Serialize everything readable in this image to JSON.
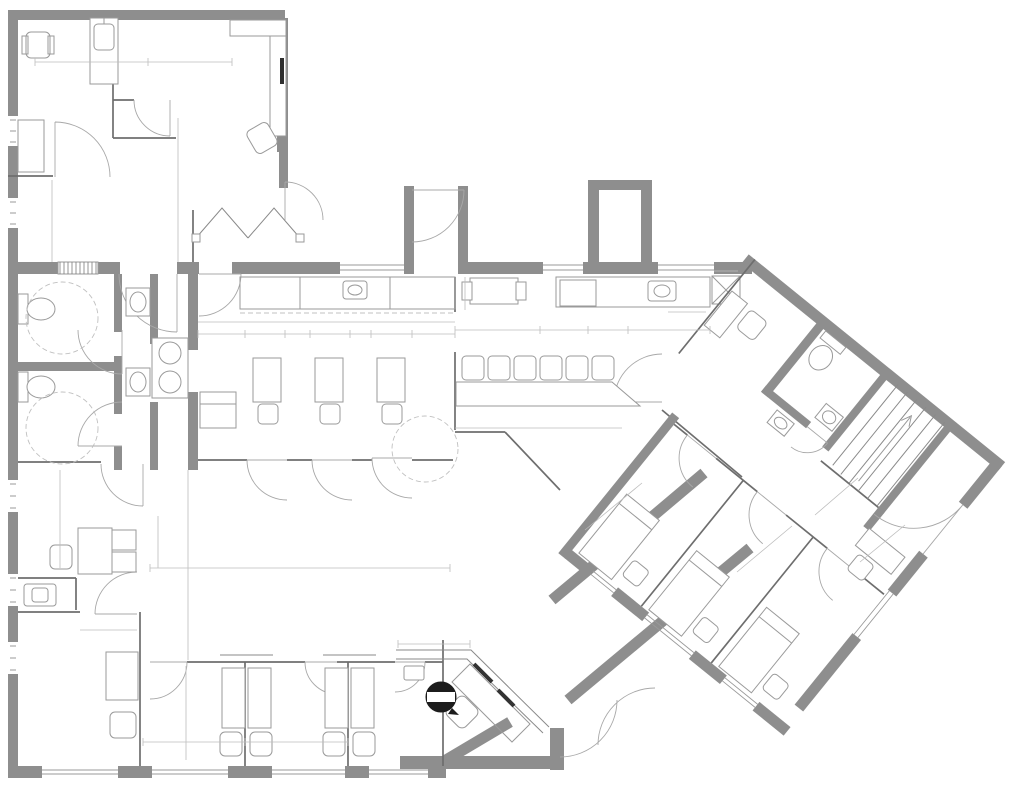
{
  "watermark": {
    "text": "A11598062 © Miami MLS® 2024"
  },
  "section_callout": {
    "label": "A1.09"
  },
  "colors": {
    "wall_gray": "#8e8e8e",
    "partition_line": "#6e6e6e",
    "dimension_text": "#5f5f5f",
    "watermark_gray": "#9b9b9b",
    "callout_black": "#2f2f2f",
    "background": "#ffffff"
  },
  "dim_labels": [
    {
      "t": "8'-4\"",
      "x": 97,
      "y": 57
    },
    {
      "t": "5'-7\"",
      "x": 185,
      "y": 57
    },
    {
      "t": "4'-0\"",
      "x": 172,
      "y": 155,
      "r": -90
    },
    {
      "t": "4'-7 1/4\"",
      "x": 172,
      "y": 207,
      "r": -90
    },
    {
      "t": "2'-6\"",
      "x": 172,
      "y": 249,
      "r": -90
    },
    {
      "t": "6'-10\"",
      "x": 46,
      "y": 222,
      "r": -90
    },
    {
      "t": "5'-2\"",
      "x": 148,
      "y": 260
    },
    {
      "t": "MIN. CLR.",
      "x": 148,
      "y": 272,
      "s": 6.5
    },
    {
      "t": "7'-6\"",
      "x": 62,
      "y": 327,
      "r": -72
    },
    {
      "t": "MIN. CLR.",
      "x": 152,
      "y": 414,
      "s": 6.5
    },
    {
      "t": "11'-9 1/4\"",
      "x": 180,
      "y": 388,
      "r": -90
    },
    {
      "t": "4'-7 1/4\"",
      "x": 183,
      "y": 447,
      "r": -90
    },
    {
      "t": "2'-0\"",
      "x": 215,
      "y": 438,
      "r": -65
    },
    {
      "t": "21'-4 1/2\"",
      "x": 313,
      "y": 326
    },
    {
      "t": "4'-9 7/8\"",
      "x": 229,
      "y": 341
    },
    {
      "t": "2'-0\"",
      "x": 266,
      "y": 341
    },
    {
      "t": "3'-0\"",
      "x": 297,
      "y": 341
    },
    {
      "t": "2'-0\"",
      "x": 328,
      "y": 341
    },
    {
      "t": "3'-0\"",
      "x": 358,
      "y": 341
    },
    {
      "t": "2'-0\"",
      "x": 389,
      "y": 341
    },
    {
      "t": "4'-6 3/4\"",
      "x": 428,
      "y": 341
    },
    {
      "t": "3'-0\"",
      "x": 221,
      "y": 369
    },
    {
      "t": "3 X 3",
      "x": 216,
      "y": 389,
      "s": 6.5
    },
    {
      "t": "3'-0\"",
      "x": 247,
      "y": 376,
      "r": -90
    },
    {
      "t": "1'-8\"",
      "x": 249,
      "y": 413,
      "r": -90
    },
    {
      "t": "68\"",
      "x": 232,
      "y": 312,
      "s": 6
    },
    {
      "t": "3'-0\"",
      "x": 460,
      "y": 294,
      "r": -90
    },
    {
      "t": "7'-0\"",
      "x": 496,
      "y": 324
    },
    {
      "t": "CLR.",
      "x": 497,
      "y": 338
    },
    {
      "t": "4'-0\"",
      "x": 564,
      "y": 324
    },
    {
      "t": "3'-1\"",
      "x": 607,
      "y": 324
    },
    {
      "t": "6'-0\"",
      "x": 662,
      "y": 324
    },
    {
      "t": "CLR.",
      "x": 607,
      "y": 338
    },
    {
      "t": "3'-0\"",
      "x": 686,
      "y": 307
    },
    {
      "t": "MIN. CLR.",
      "x": 346,
      "y": 426,
      "s": 6.5
    },
    {
      "t": "4'-0\"",
      "x": 271,
      "y": 443,
      "r": -90
    },
    {
      "t": "CLR.",
      "x": 286,
      "y": 443,
      "r": -90
    },
    {
      "t": "5'-0\"",
      "x": 420,
      "y": 447
    },
    {
      "t": "CLR.",
      "x": 420,
      "y": 461
    },
    {
      "t": "13'-11 1/8\"",
      "x": 538,
      "y": 422
    },
    {
      "t": "11'-5\"",
      "x": 469,
      "y": 468,
      "r": -90
    },
    {
      "t": "5'-2\"",
      "x": 606,
      "y": 505,
      "r": 39
    },
    {
      "t": "MIN. CLR.",
      "x": 597,
      "y": 517,
      "r": 39,
      "s": 6.5
    },
    {
      "t": "5'-2\"",
      "x": 756,
      "y": 545,
      "r": 39
    },
    {
      "t": "MIN. CLR.",
      "x": 766,
      "y": 556,
      "r": 39,
      "s": 6.5
    },
    {
      "t": "7'-6\"",
      "x": 836,
      "y": 484,
      "r": 39
    },
    {
      "t": "4'-4\"",
      "x": 893,
      "y": 530,
      "r": 39
    },
    {
      "t": "MIN. CLR.",
      "x": 884,
      "y": 542,
      "r": 39,
      "s": 6.5
    },
    {
      "t": "9'-1\"",
      "x": 56,
      "y": 522,
      "r": -90
    },
    {
      "t": "4'-0\"",
      "x": 154,
      "y": 543,
      "r": -90
    },
    {
      "t": "15'-6\"",
      "x": 181,
      "y": 580,
      "r": -90
    },
    {
      "t": "26'-0\"",
      "x": 299,
      "y": 564
    },
    {
      "t": "60\"",
      "x": 108,
      "y": 624,
      "s": 6.5
    },
    {
      "t": "MIN. CLR.",
      "x": 108,
      "y": 634,
      "s": 6.5
    },
    {
      "t": "8'-8\"",
      "x": 182,
      "y": 711,
      "r": -90
    },
    {
      "t": "8'-8\"",
      "x": 203,
      "y": 740
    },
    {
      "t": "8'-8\"",
      "x": 302,
      "y": 740
    },
    {
      "t": "4'-0\"",
      "x": 436,
      "y": 638
    },
    {
      "t": "18\"",
      "x": 400,
      "y": 684,
      "s": 6
    },
    {
      "t": "MIN. CLR",
      "x": 400,
      "y": 693,
      "s": 6
    }
  ]
}
